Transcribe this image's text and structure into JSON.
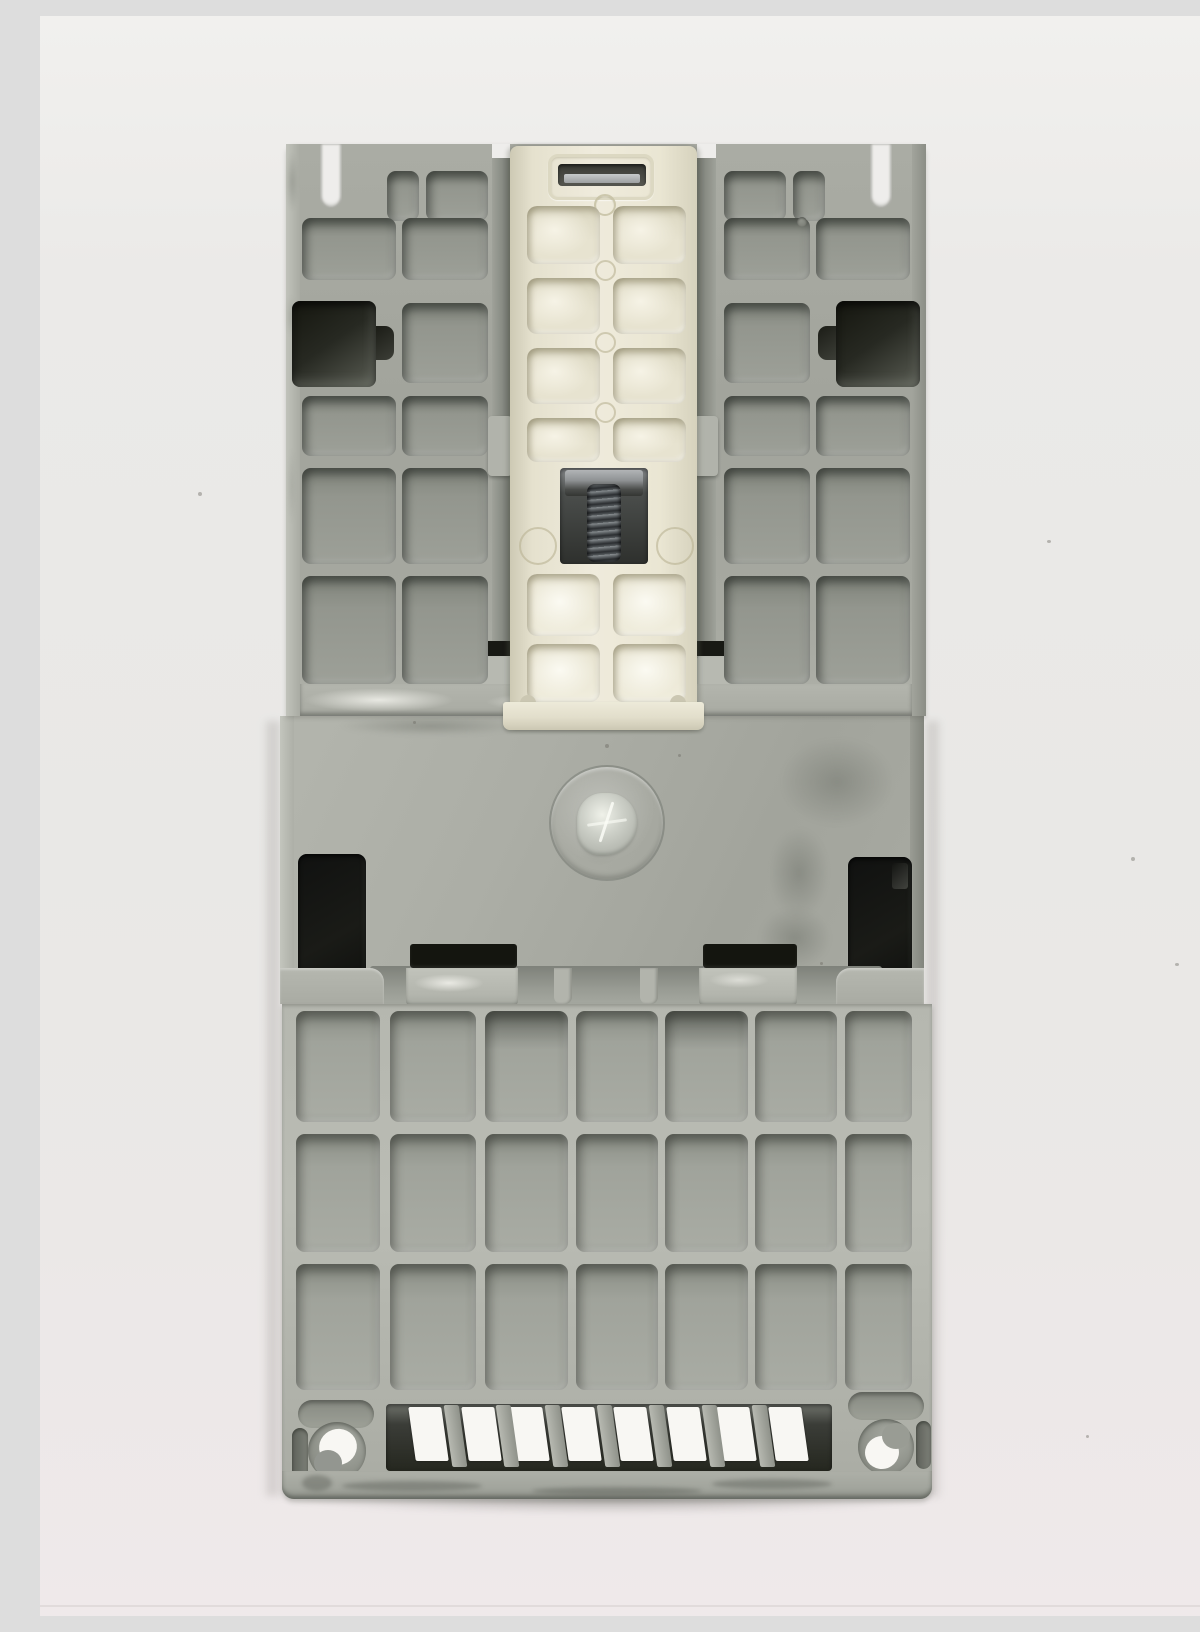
{
  "scene": {
    "caption": "Rear view photograph of a light-gray molded industrial control module (contactor / motor starter) lying on a white backdrop. The back shows ribbed rectangular compartments, a cream-colored DIN-rail mounting clip with a steel coil return spring and a rectangular latch slot, a circular mold emblem on the smooth mid panel, two dark rectangular mounting apertures, a 7-by-3 grid of ribbed cells below, a row of eight slanted vent slots, and two round mounting holes near the bottom corners.",
    "photo_subject": "industrial contactor rear housing with DIN-rail spring clip"
  },
  "palette": {
    "backdrop": "#ebeae8",
    "backdrop_warm_bottom": "#efe9ea",
    "body_gray": "#a9aba3",
    "body_light": "#b9bbb3",
    "body_shadow": "#83867e",
    "cavity_dark": "#262823",
    "aperture_black": "#14150f",
    "clip_cream": "#eae6d3",
    "clip_recess": "#ddd9c3",
    "spring_steel": "#565b5e",
    "metal_bar": "#b9bcbd",
    "vent_white": "#f8f7f3"
  },
  "structure": {
    "top_section": {
      "cell_count": 22,
      "mounting_pockets": 2,
      "top_notches": 2
    },
    "din_clip": {
      "cell_columns": 2,
      "cell_rows": 6,
      "top_latch_slot": 1,
      "coil_spring": 1,
      "molded_circles": 2
    },
    "mid_panel": {
      "circular_emblem": 1,
      "dark_apertures": 2,
      "latch_slots": 2
    },
    "bottom_section": {
      "grid_columns": 7,
      "grid_rows": 3,
      "vent_slots": 8,
      "round_mounting_holes": 2,
      "corner_slots": 2
    }
  }
}
